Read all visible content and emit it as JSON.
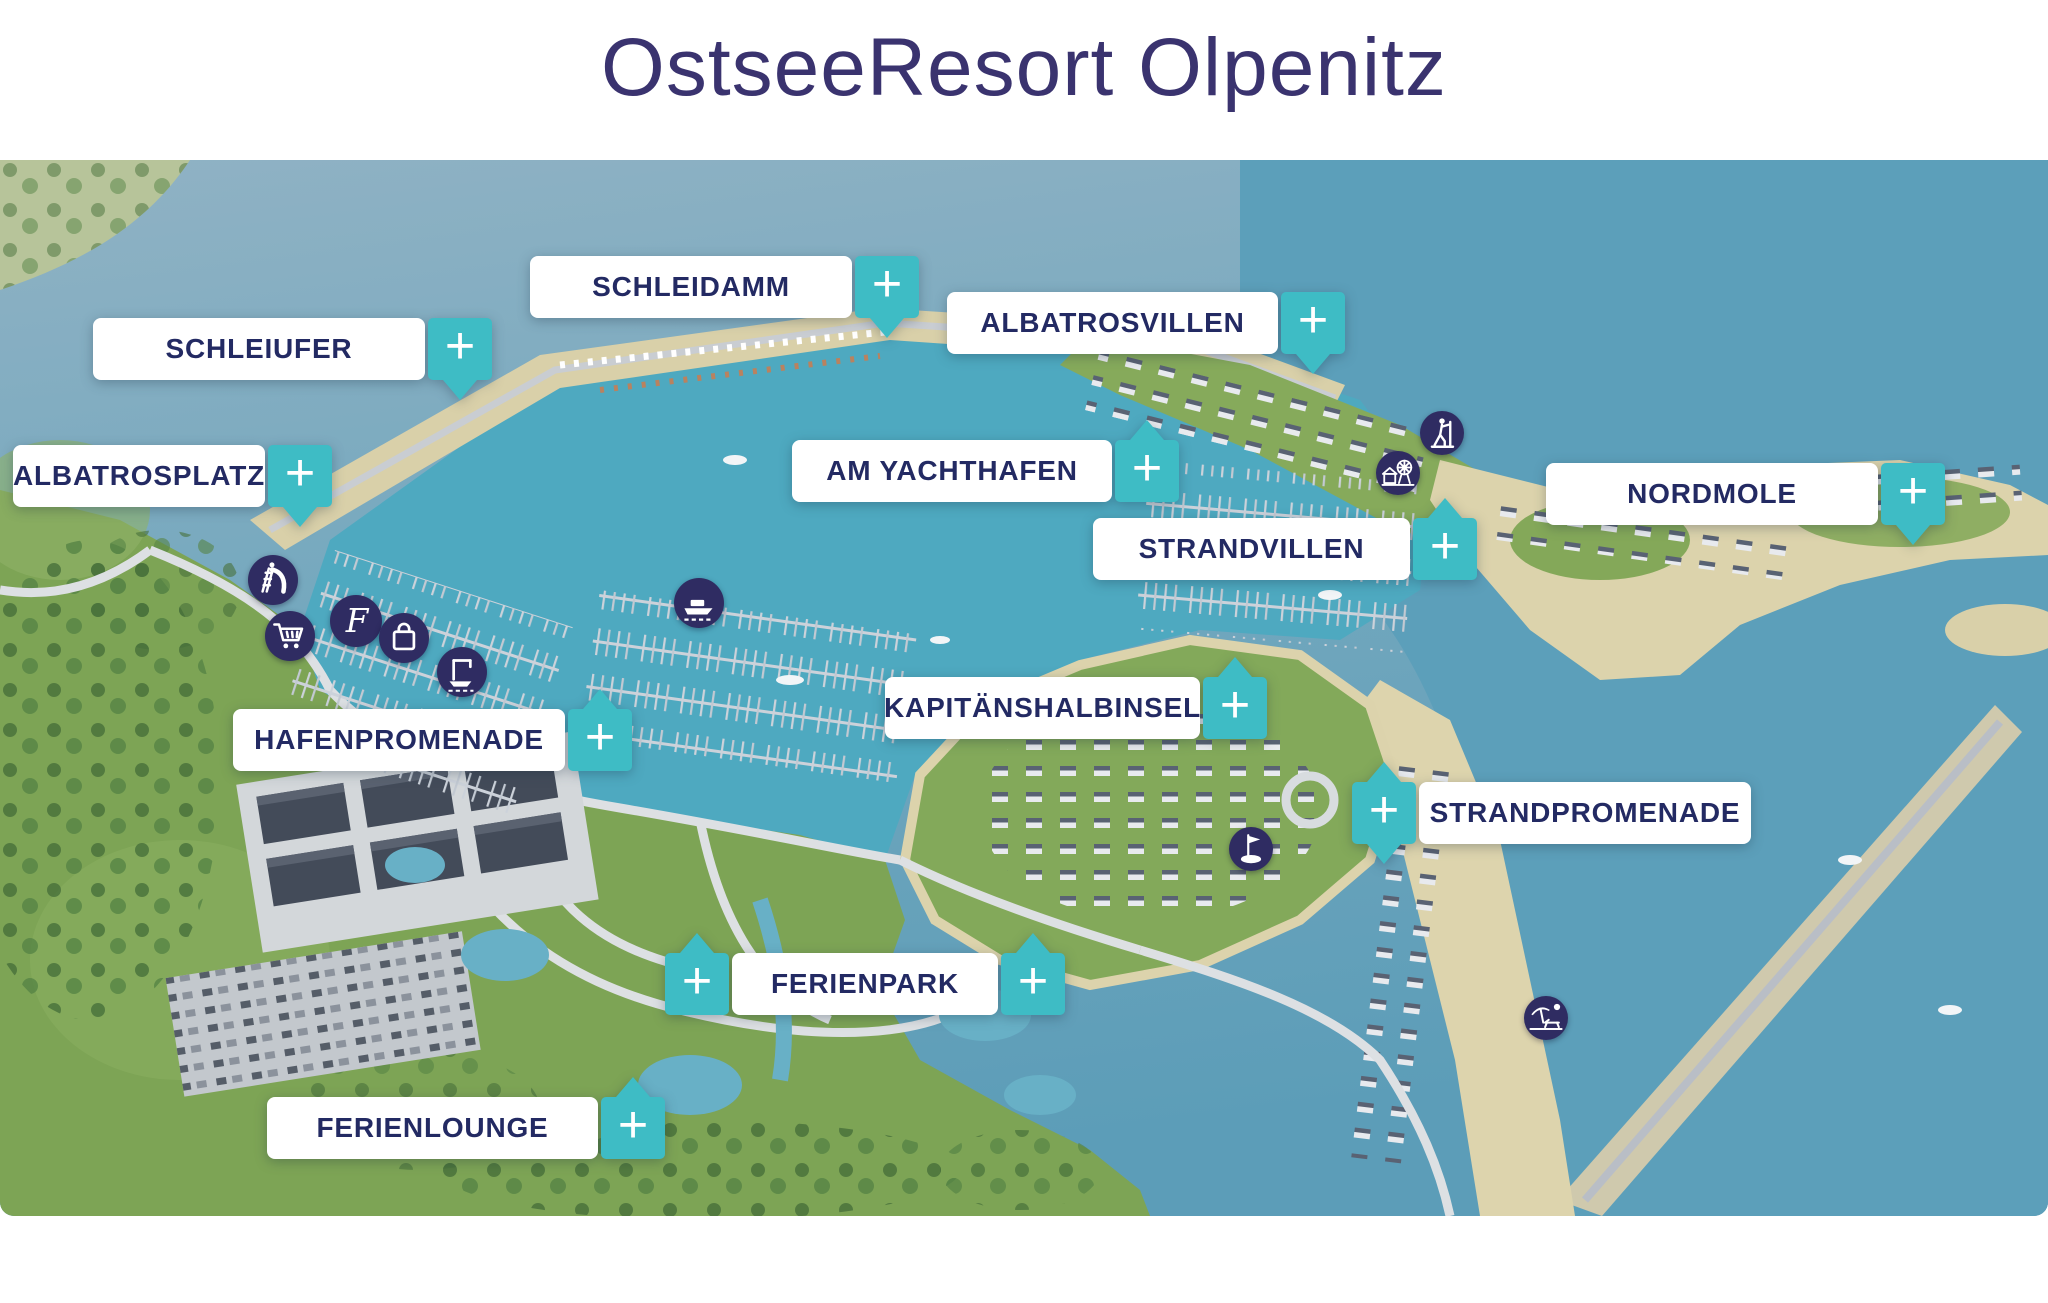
{
  "title": "OstseeResort Olpenitz",
  "ui": {
    "plus_sign": "+"
  },
  "markers": {
    "schleidamm": {
      "label": "SCHLEIDAMM"
    },
    "schleiufer": {
      "label": "SCHLEIUFER"
    },
    "albatrosvillen": {
      "label": "ALBATROSVILLEN"
    },
    "albatrosplatz": {
      "label": "ALBATROSPLATZ"
    },
    "am_yachthafen": {
      "label": "AM YACHTHAFEN"
    },
    "nordmole": {
      "label": "NORDMOLE"
    },
    "strandvillen": {
      "label": "STRANDVILLEN"
    },
    "kapitaenshalbinsel": {
      "label": "KAPITÄNSHALBINSEL"
    },
    "hafenpromenade": {
      "label": "HAFENPROMENADE"
    },
    "strandpromenade": {
      "label": "STRANDPROMENADE"
    },
    "ferienpark": {
      "label": "FERIENPARK"
    },
    "ferienlounge": {
      "label": "FERIENLOUNGE"
    }
  },
  "poi_icons": [
    {
      "name": "waterslide-icon"
    },
    {
      "name": "monogram-f-icon"
    },
    {
      "name": "shopping-cart-icon"
    },
    {
      "name": "shopping-bag-icon"
    },
    {
      "name": "boat-crane-icon"
    },
    {
      "name": "ferry-icon"
    },
    {
      "name": "hiking-icon"
    },
    {
      "name": "amusement-icon"
    },
    {
      "name": "golf-icon"
    },
    {
      "name": "beach-icon"
    }
  ],
  "colors": {
    "title_text": "#3A336F",
    "label_text": "#232A63",
    "plus_teal": "#3EBCC5",
    "poi_navy": "#2F2C62",
    "water_outer": "#8DB0C3",
    "water_harbor": "#4EA9C0",
    "water_bay": "#5C9FBA",
    "land_green": "#7DA455",
    "sand": "#DCD3AC"
  }
}
